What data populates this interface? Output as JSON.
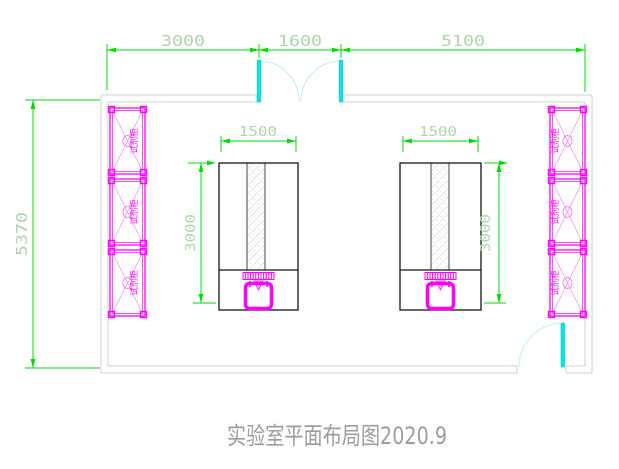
{
  "title": "实验室平面布局图2020.9",
  "dims": {
    "top_left": "3000",
    "top_mid": "1600",
    "top_right": "5100",
    "left_overall": "5370",
    "bench1_w": "1500",
    "bench1_h": "3000",
    "bench2_w": "1500",
    "bench2_h": "3000"
  },
  "cabinet_label": "试剂柜",
  "colors": {
    "dimension_line": "#00dc00",
    "dimension_text": "#aed4ae",
    "wall": "#d2d2d2",
    "door_leaf": "#00ecec",
    "door_arc": "#c9f2ef",
    "cabinet": "#ff00ff",
    "bench": "#141414",
    "title_text": "#9c9c9c"
  }
}
